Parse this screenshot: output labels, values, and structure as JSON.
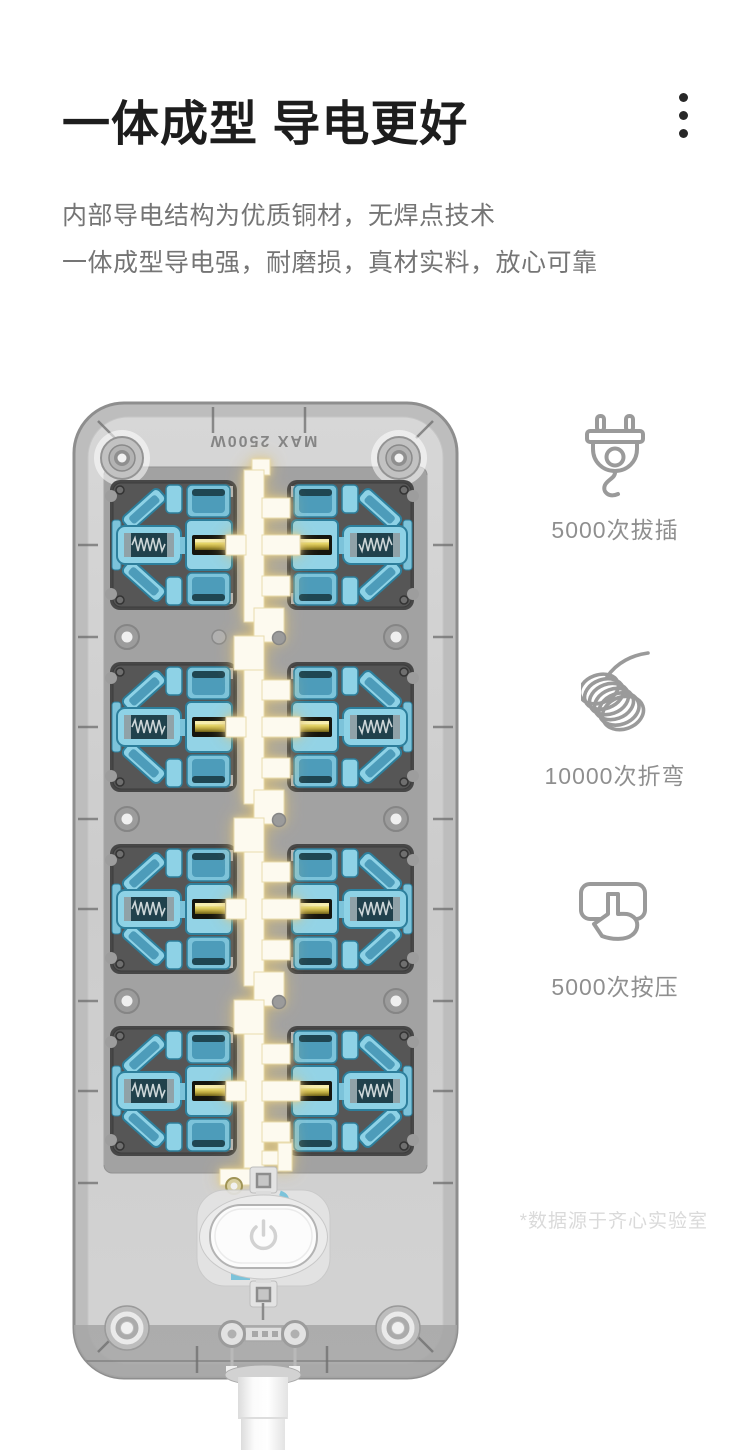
{
  "header": {
    "title": "一体成型 导电更好",
    "subtitle_line1": "内部导电结构为优质铜材，无焊点技术",
    "subtitle_line2": "一体成型导电强，耐磨损，真材实料，放心可靠",
    "menu_icon": "vertical-ellipsis"
  },
  "features": [
    {
      "icon": "plug-icon",
      "label": "5000次拔插"
    },
    {
      "icon": "coil-wire-icon",
      "label": "10000次折弯"
    },
    {
      "icon": "press-button-icon",
      "label": "5000次按压"
    }
  ],
  "product": {
    "marking": "MAX 2500W",
    "description": "transparent rear view of power strip showing 8 blue socket modules and one-piece copper busbar",
    "power_button_symbol": "power"
  },
  "footnote": "*数据源于齐心实验室",
  "colors": {
    "title_text": "#1d1d1d",
    "body_text": "#757575",
    "icon_stroke": "#9a9a9a",
    "label_text": "#8f8f8f",
    "footnote_text": "#dadada",
    "socket_blue": "#8ed2e6",
    "socket_blue_dark": "#2d7f9c",
    "copper_glow": "#e6d193",
    "copper_core": "#fdfaef",
    "case_gray": "#cfcfcf",
    "frame_gray": "#4a4a4a"
  }
}
